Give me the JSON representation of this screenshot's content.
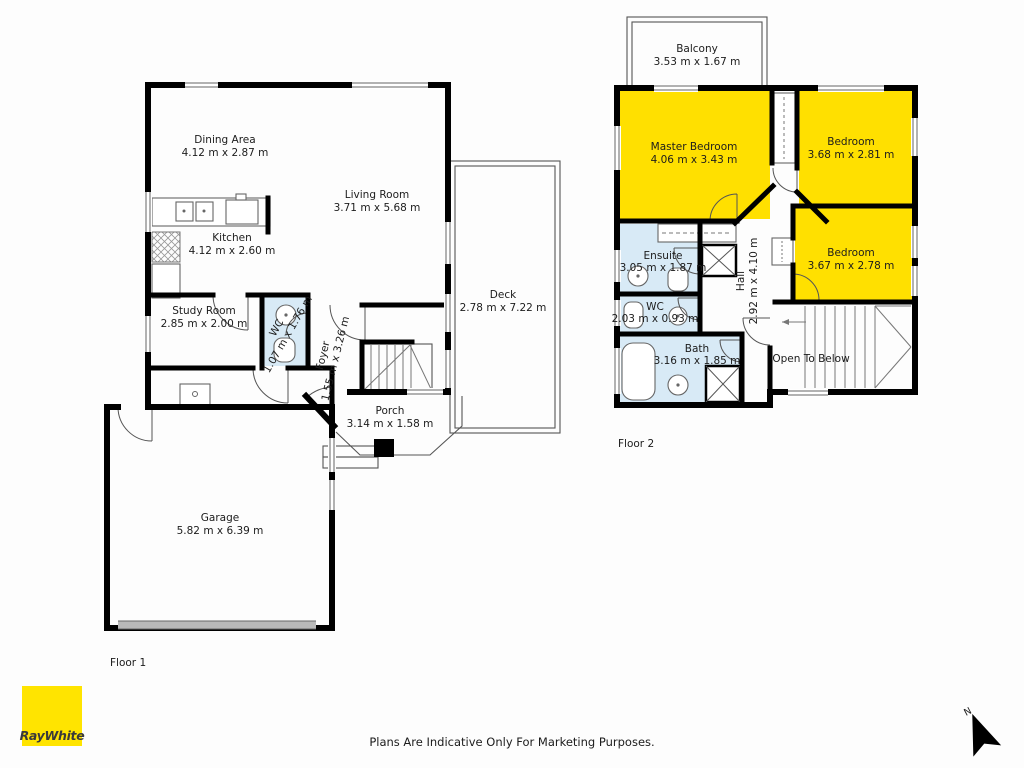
{
  "page": {
    "disclaimer": "Plans Are Indicative Only For Marketing Purposes.",
    "brand": {
      "name": "RayWhite"
    },
    "compass": {
      "north": "N"
    },
    "colors": {
      "room_highlight_yellow": "#ffe000",
      "wet_area_blue": "#d8eaf6",
      "wall_black": "#000000",
      "brand_yellow": "#ffe400",
      "garage_door_grey": "#b9b9b9"
    }
  },
  "floor1": {
    "label": "Floor 1",
    "rooms": {
      "dining": {
        "name": "Dining Area",
        "dims": "4.12 m x 2.87 m"
      },
      "living": {
        "name": "Living Room",
        "dims": "3.71 m x 5.68 m"
      },
      "kitchen": {
        "name": "Kitchen",
        "dims": "4.12 m x 2.60 m"
      },
      "study": {
        "name": "Study Room",
        "dims": "2.85 m x 2.00 m"
      },
      "wc": {
        "name": "WC",
        "dims": "1.07 m x 1.76 m"
      },
      "foyer": {
        "name": "Foyer",
        "dims": "1.55 m x 3.26 m"
      },
      "porch": {
        "name": "Porch",
        "dims": "3.14 m x 1.58 m"
      },
      "deck": {
        "name": "Deck",
        "dims": "2.78 m x 7.22 m"
      },
      "garage": {
        "name": "Garage",
        "dims": "5.82 m x 6.39 m"
      }
    }
  },
  "floor2": {
    "label": "Floor 2",
    "rooms": {
      "balcony": {
        "name": "Balcony",
        "dims": "3.53 m x 1.67 m"
      },
      "master": {
        "name": "Master Bedroom",
        "dims": "4.06 m x 3.43 m"
      },
      "bedroom_top": {
        "name": "Bedroom",
        "dims": "3.68 m x 2.81 m"
      },
      "bedroom_right": {
        "name": "Bedroom",
        "dims": "3.67 m x 2.78 m"
      },
      "ensuite": {
        "name": "Ensuite",
        "dims": "3.05 m x 1.87 m"
      },
      "hall": {
        "name": "Hall",
        "dims": "2.92 m x 4.10 m"
      },
      "wc": {
        "name": "WC",
        "dims": "2.03 m x 0.93 m"
      },
      "bath": {
        "name": "Bath",
        "dims": "3.16 m x 1.85 m"
      },
      "open_to_below": {
        "name": "Open To Below"
      }
    }
  }
}
